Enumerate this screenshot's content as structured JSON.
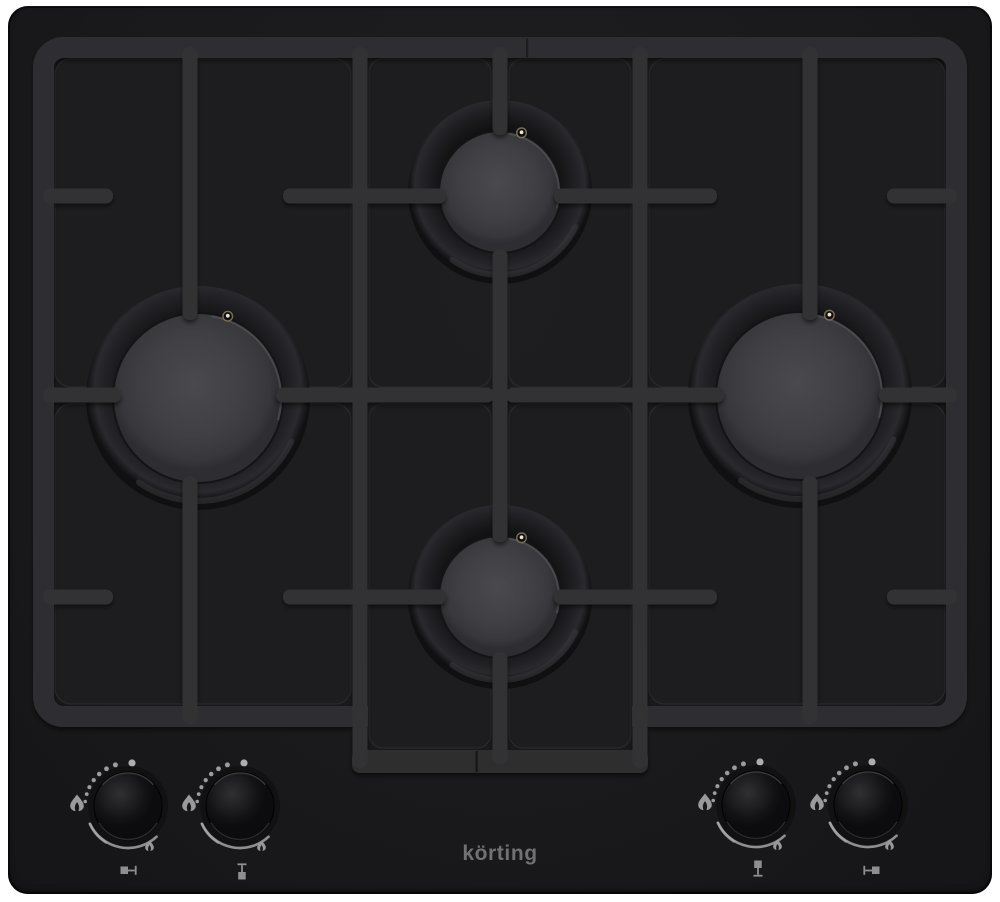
{
  "product": {
    "category": "built-in gas cooktop (hob), black glass",
    "brand": "körting",
    "burner_count": 4,
    "control_knob_count": 4
  },
  "logo": {
    "text": "körting",
    "color": "#717171"
  },
  "surface": {
    "glass_color": "#1a1a1c",
    "grate_color": "#323235",
    "panel_color": "#1e1e21",
    "background_color": "#ffffff"
  },
  "burners": [
    {
      "id": "left",
      "name": "burner-left",
      "x": 198,
      "y": 398,
      "ring_radius": 112,
      "cap_radius": 85,
      "features": [
        "ignition-electrode"
      ]
    },
    {
      "id": "rear-center",
      "name": "burner-rear-center",
      "x": 500,
      "y": 192,
      "ring_radius": 92,
      "cap_radius": 61,
      "features": [
        "ignition-electrode"
      ]
    },
    {
      "id": "front-center",
      "name": "burner-front-center",
      "x": 500,
      "y": 597,
      "ring_radius": 92,
      "cap_radius": 61,
      "features": [
        "ignition-electrode"
      ]
    },
    {
      "id": "right",
      "name": "burner-right",
      "x": 800,
      "y": 396,
      "ring_radius": 112,
      "cap_radius": 84,
      "features": [
        "ignition-electrode"
      ]
    }
  ],
  "knob_markings": {
    "off_position": "dot-at-top",
    "ignition_zone": "dotted-arc-upper-left",
    "max_power": "large-flame-icon-left",
    "power_range": "solid-arc-bottom",
    "min_power": "small-flame-icon-lower-right"
  },
  "knobs": [
    {
      "id": "left",
      "name": "knob-burner-left",
      "x": 128,
      "y": 806,
      "position_icon": "left"
    },
    {
      "id": "front-center",
      "name": "knob-burner-front-center",
      "x": 240,
      "y": 806,
      "position_icon": "front"
    },
    {
      "id": "rear-center",
      "name": "knob-burner-rear-center",
      "x": 756,
      "y": 805,
      "position_icon": "rear"
    },
    {
      "id": "right",
      "name": "knob-burner-right",
      "x": 868,
      "y": 805,
      "position_icon": "right"
    }
  ]
}
